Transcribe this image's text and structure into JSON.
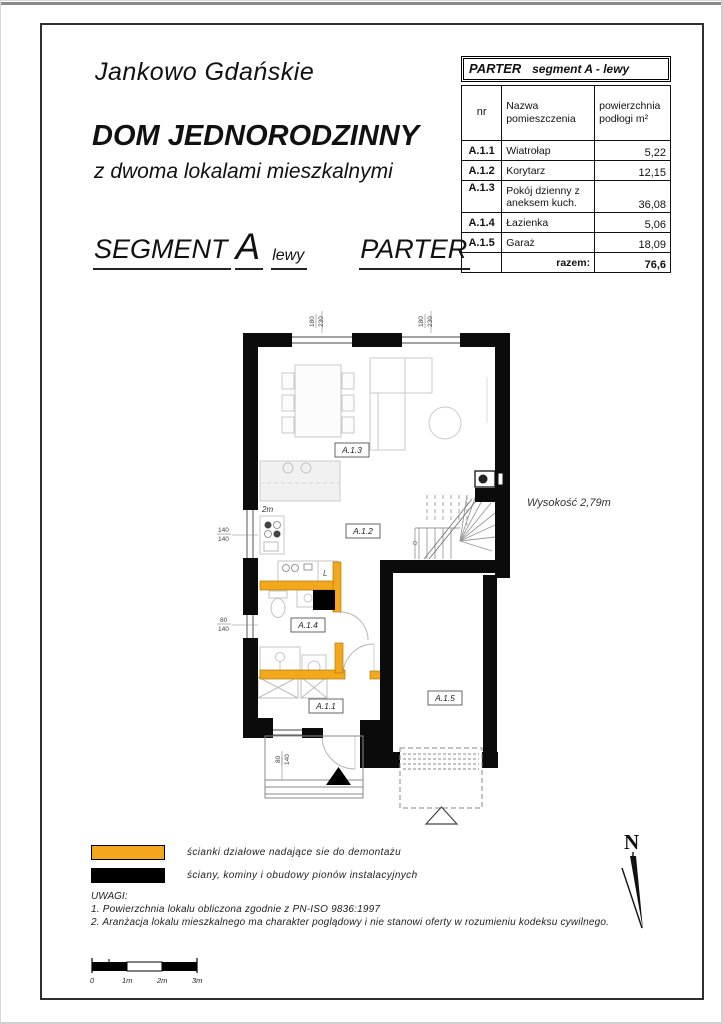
{
  "header": {
    "location": "Jankowo Gdańskie",
    "title": "DOM JEDNORODZINNY",
    "subtitle": "z dwoma lokalami mieszkalnymi",
    "segment_word": "SEGMENT",
    "segment_letter": "A",
    "segment_variant": "lewy",
    "floor": "PARTER"
  },
  "area_table": {
    "title_floor": "PARTER",
    "title_segment": "segment A - lewy",
    "col_nr": "nr",
    "col_name": "Nazwa pomieszczenia",
    "col_area": "powierzchnia podłogi m²",
    "rows": [
      {
        "nr": "A.1.1",
        "name": "Wiatrołap",
        "area": "5,22"
      },
      {
        "nr": "A.1.2",
        "name": "Korytarz",
        "area": "12,15"
      },
      {
        "nr": "A.1.3",
        "name": "Pokój dzienny z aneksem kuch.",
        "area": "36,08"
      },
      {
        "nr": "A.1.4",
        "name": "Łazienka",
        "area": "5,06"
      },
      {
        "nr": "A.1.5",
        "name": "Garaż",
        "area": "18,09"
      }
    ],
    "total_label": "razem:",
    "total_value": "76,6"
  },
  "plan": {
    "room_labels": {
      "a11": "A.1.1",
      "a12": "A.1.2",
      "a13": "A.1.3",
      "a14": "A.1.4",
      "a15": "A.1.5"
    },
    "dims": {
      "top_window_1_w": "180",
      "top_window_1_h": "230",
      "top_window_2_w": "180",
      "top_window_2_h": "230",
      "left_window_1_w": "140",
      "left_window_1_h": "140",
      "left_window_2_w": "80",
      "left_window_2_h": "140",
      "bottom_window_w": "80",
      "bottom_window_h": "140"
    },
    "kitchen_depth_note": "2m",
    "fridge_mark": "L",
    "height_note": "Wysokość  2,79m"
  },
  "legend": {
    "items": [
      {
        "swatch_color": "#F2A71D",
        "label": "ścianki działowe nadające sie do demontażu"
      },
      {
        "swatch_color": "#000000",
        "label": "ściany, kominy i obudowy pionów instalacyjnych"
      }
    ],
    "notes_title": "UWAGI:",
    "notes": [
      "1.  Powierzchnia lokalu obliczona zgodnie z PN-ISO  9836:1997",
      "2.  Aranżacja lokalu mieszkalnego ma charakter poglądowy i nie stanowi oferty w rozumieniu kodeksu cywilnego."
    ]
  },
  "compass": {
    "label": "N"
  },
  "scale_bar": {
    "labels": [
      "0",
      "1m",
      "2m",
      "3m"
    ]
  },
  "colors": {
    "partition_wall": "#F2A71D",
    "structural_wall": "#000000"
  }
}
